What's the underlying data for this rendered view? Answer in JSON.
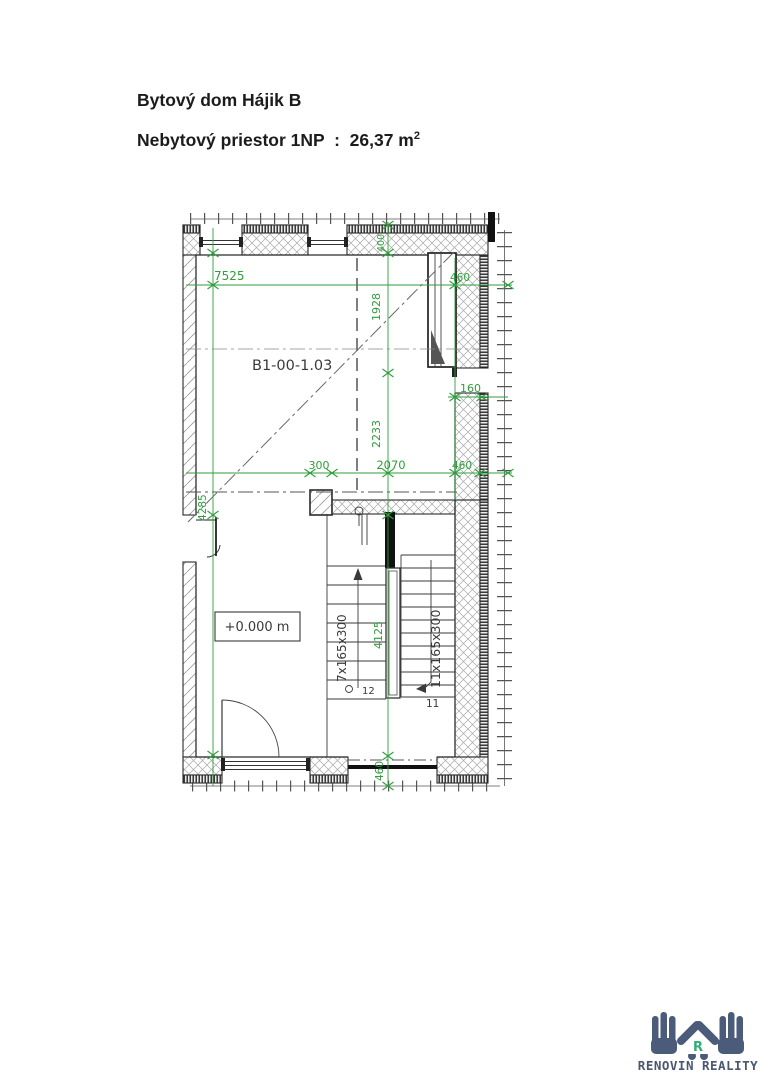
{
  "header": {
    "title": "Bytový dom Hájik B",
    "subtitle": "Nebytový priestor 1NP  :  26,37 m",
    "subtitle_sup": "2"
  },
  "plan": {
    "room_label": "B1-00-1.03",
    "level_label": "+0.000 m",
    "stairs": {
      "left_flight": "7x165x300",
      "right_flight": "11x165x300",
      "step_left": "12",
      "step_right": "11"
    },
    "dims": {
      "width_top": "7525",
      "depth_upper": "1928",
      "depth_mid": "2233",
      "column": "300",
      "opening_mid": "2070",
      "wall_right_top": "460",
      "door_right": "160",
      "wall_right_mid": "460",
      "depth_lower": "4285",
      "wall_top": "400",
      "stair_run": "4125",
      "wall_bottom": "460"
    },
    "colors": {
      "dimension": "#2f9e3c",
      "drawing": "#3a3a3a"
    }
  },
  "logo": {
    "brand": "RENOVIN REALITY",
    "monogram": "R",
    "colors": {
      "hands": "#4b5b7a",
      "accent": "#2fae76",
      "text": "#4a5672"
    }
  }
}
